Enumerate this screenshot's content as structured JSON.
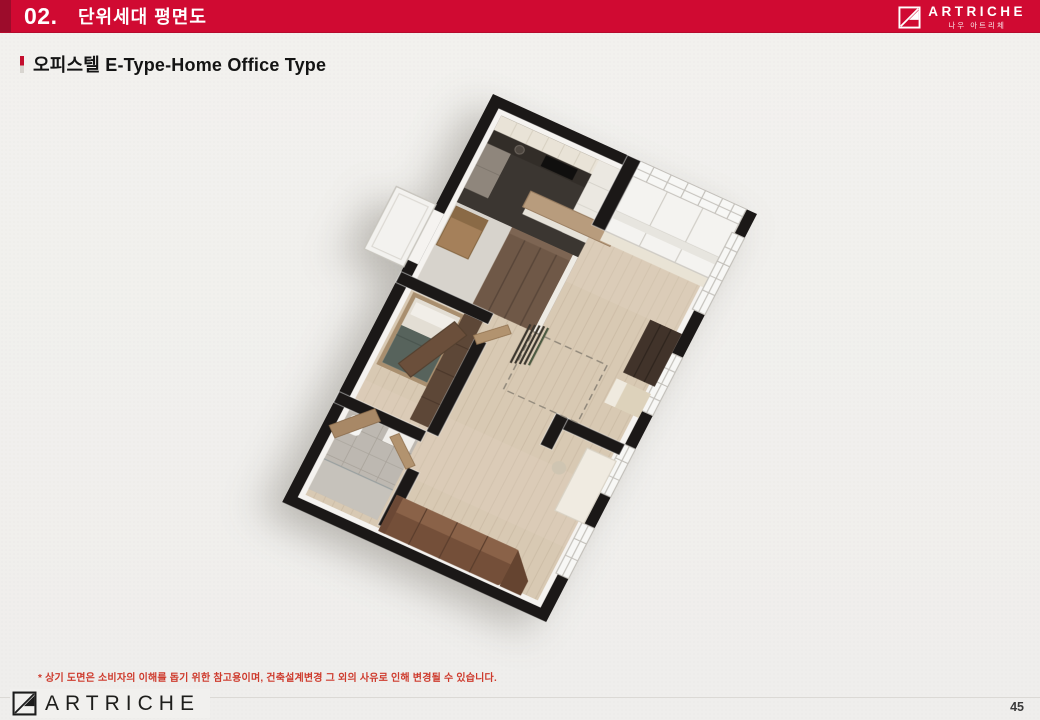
{
  "slide": {
    "section_number": "02.",
    "section_title": "단위세대 평면도",
    "subtitle": "오피스텔 E-Type-Home Office Type",
    "disclaimer": "* 상기 도면은 소비자의 이해를 돕기 위한 참고용이며, 건축설계변경 그 외의 사유로 인해 변경될 수 있습니다.",
    "page_number": "45"
  },
  "brand": {
    "name": "ARTRICHE",
    "korean_name": "나우 아트리체"
  },
  "colors": {
    "accent_red": "#d00a32",
    "accent_red_dark": "#9c0c2b",
    "disclaimer_red": "#ce3b2d",
    "wall_black": "#1b1817",
    "floor_wood": "#d8c9b3",
    "paper": "#f1f0ee"
  }
}
